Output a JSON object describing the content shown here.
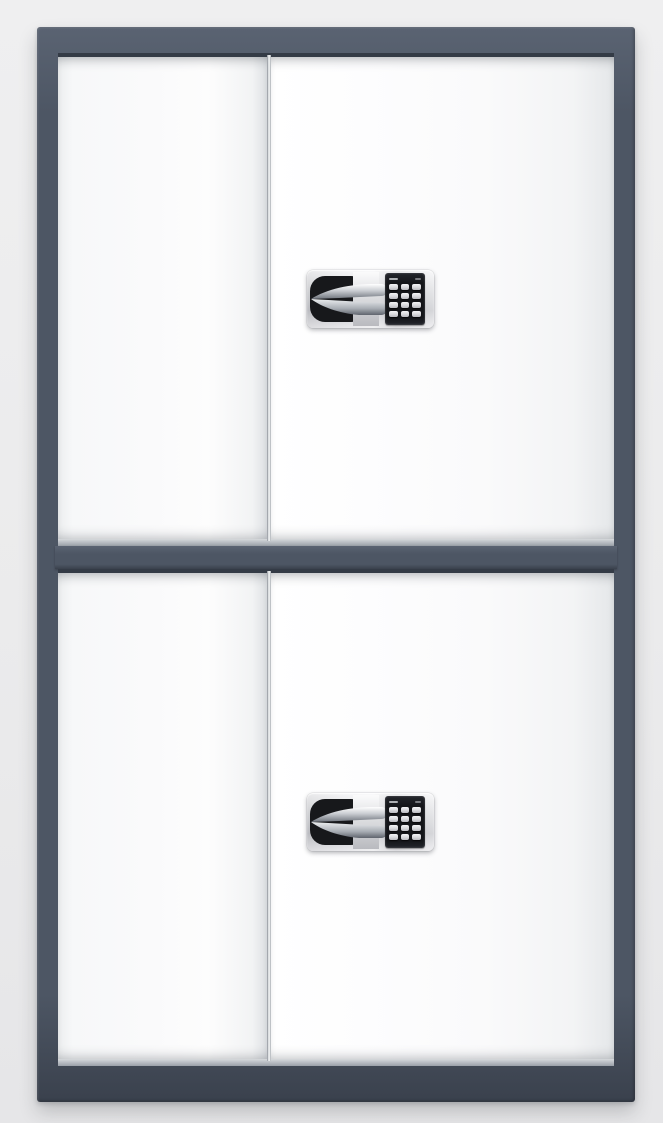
{
  "image_type": "product-photo",
  "subject": "two-tier steel security cabinet with white double doors and electronic keypad locks",
  "colors": {
    "background_top": "#efeff0",
    "background_mid": "#ebebec",
    "background_bottom": "#e6e6e8",
    "frame": "#4d5664",
    "frame_light": "#5a6372",
    "frame_dark": "#3a414d",
    "gap_dark": "#343b46",
    "door_white": "#fafafb",
    "lock_plate_silver": "#dbdcdf",
    "handle_black": "#17181b",
    "chrome_light": "#f7f8f9",
    "chrome_dark": "#7c828b",
    "keypad_black": "#141519",
    "key_gray": "#d8d8dc"
  },
  "cabinet": {
    "tiers": 2,
    "sections": [
      {
        "name": "upper",
        "doors": 2,
        "has_lock": true
      },
      {
        "name": "lower",
        "doors": 2,
        "has_lock": true
      }
    ],
    "lock": {
      "type": "electronic keypad with swing handle",
      "keypad_rows": 4,
      "keypad_cols": 3
    }
  }
}
